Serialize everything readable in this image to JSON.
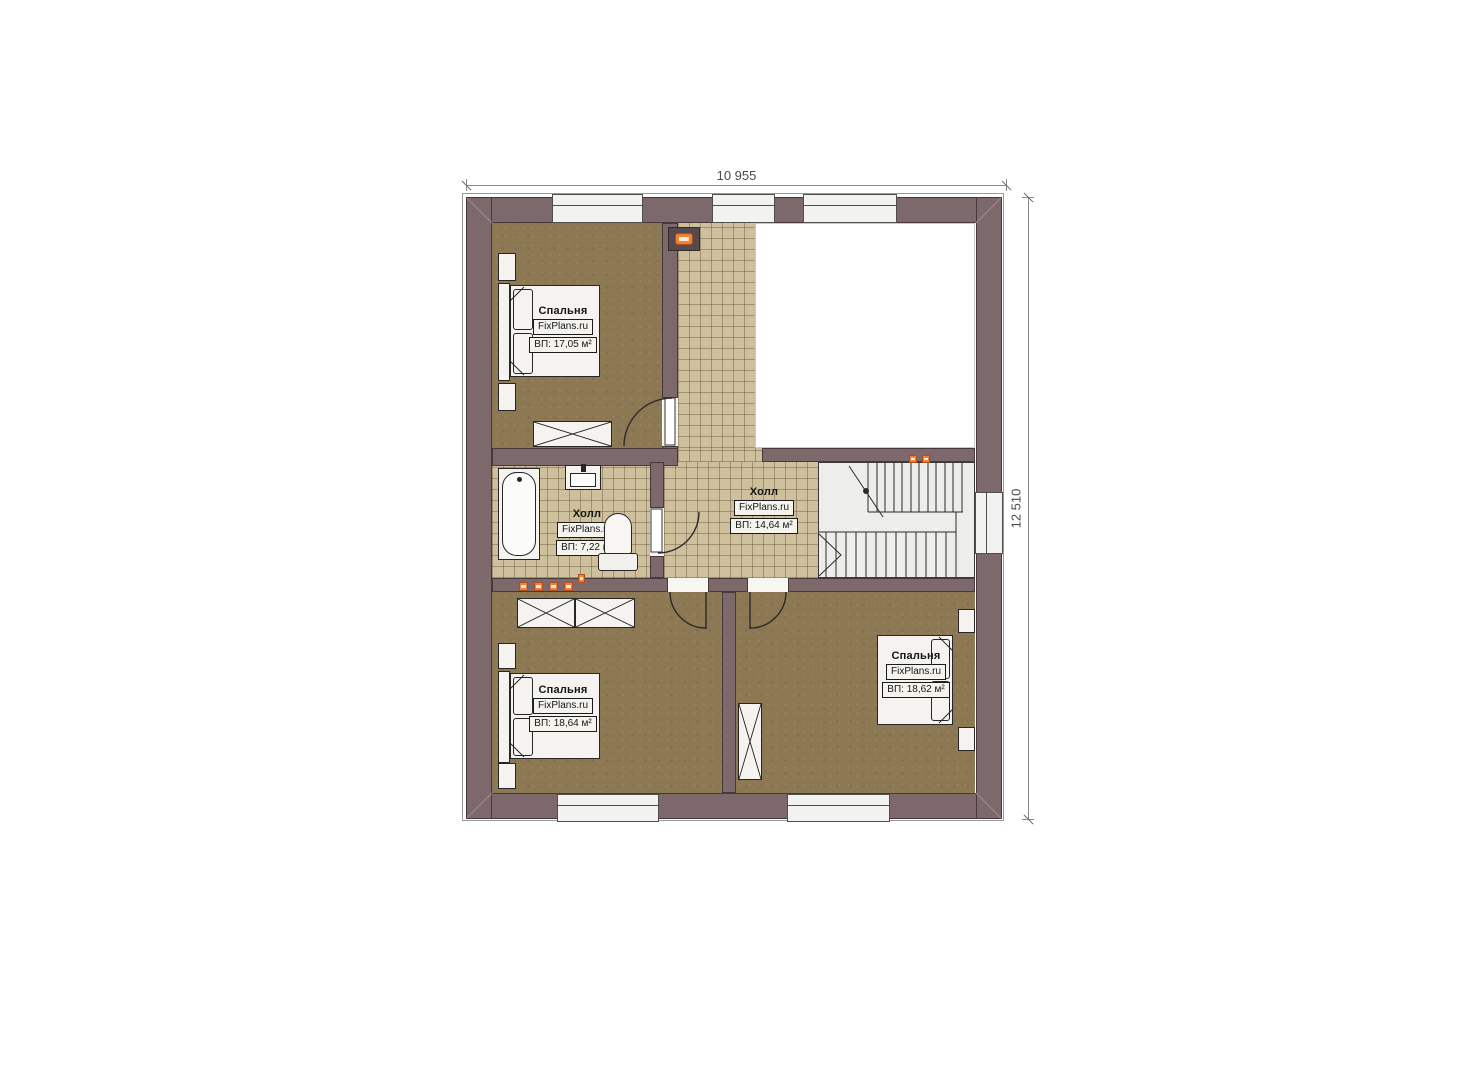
{
  "dimensions": {
    "width_label": "10 955",
    "height_label": "12 510"
  },
  "watermark": "FixPlans.ru",
  "rooms": {
    "bedroom_top_left": {
      "name": "Спальня",
      "area": "ВП: 17,05 м²"
    },
    "hall_bath": {
      "name": "Холл",
      "area": "ВП: 7,22 м²"
    },
    "hall_center": {
      "name": "Холл",
      "area": "ВП: 14,64 м²"
    },
    "bedroom_bottom_left": {
      "name": "Спальня",
      "area": "ВП: 18,64 м²"
    },
    "bedroom_bottom_right": {
      "name": "Спальня",
      "area": "ВП: 18,62 м²"
    }
  },
  "colors": {
    "wall": "#7d696b",
    "bedroom_floor": "#8c7852",
    "tile_floor": "#cec09c",
    "stairs": "#ededeb",
    "accent_orange": "#f08034",
    "background": "#ffffff"
  }
}
